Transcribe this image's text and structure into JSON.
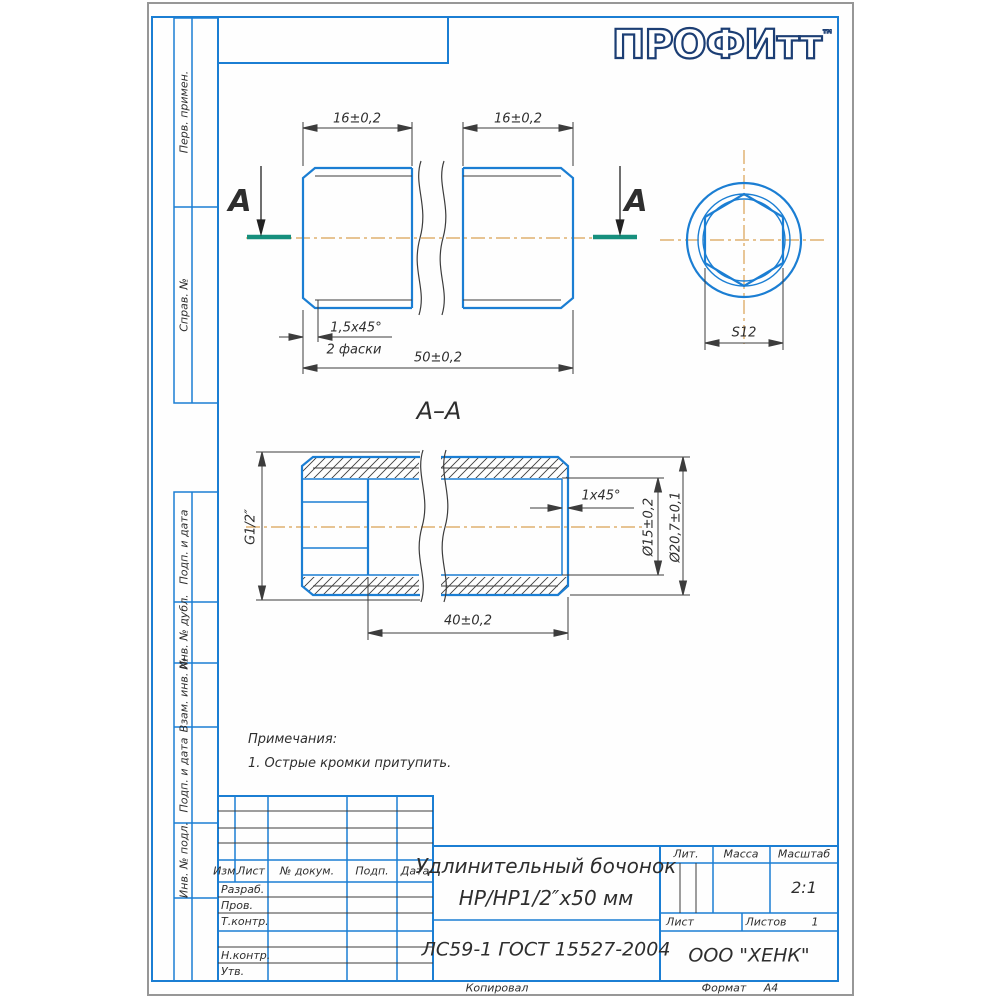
{
  "colors": {
    "frame_blue": "#1b7ed3",
    "line_dark": "#3c3c3c",
    "centerline_orange": "#d9a253",
    "section_teal": "#168f7d",
    "logo_navy": "#1c3e74"
  },
  "logo": {
    "text": "ПРОФИтт",
    "tm": "™"
  },
  "sidebar": {
    "items": [
      {
        "label": "Перв. примен."
      },
      {
        "label": "Справ. №"
      },
      {
        "label": "Подп. и дата"
      },
      {
        "label": "Инв. № дубл."
      },
      {
        "label": "Взам. инв. №"
      },
      {
        "label": "Подп. и дата"
      },
      {
        "label": "Инв. № подл."
      }
    ]
  },
  "drawing": {
    "side_view": {
      "section_letter": "А",
      "dim_thread_left": "16±0,2",
      "dim_thread_right": "16±0,2",
      "dim_overall": "50±0,2",
      "dim_chamfer": "1,5х45°",
      "chamfer_note": "2 фаски"
    },
    "end_view": {
      "dim_hex": "S12"
    },
    "section_view": {
      "label": "А–А",
      "dim_thread": "G1/2″",
      "dim_chamfer": "1х45°",
      "dim_bore": "Ø15±0,2",
      "dim_outer": "Ø20,7±0,1",
      "dim_length": "40±0,2"
    }
  },
  "notes": {
    "heading": "Примечания:",
    "item1": "1. Острые кромки притупить."
  },
  "title_block": {
    "header": {
      "izm": "Изм.",
      "list": "Лист",
      "doc": "№ докум.",
      "sign": "Подп.",
      "date": "Дата"
    },
    "rows": {
      "r1": "Разраб.",
      "r2": "Пров.",
      "r3": "Т.контр.",
      "r4": "Н.контр.",
      "r5": "Утв."
    },
    "name_line1": "Удлинительный бочонок",
    "name_line2": "НР/НР1/2″х50 мм",
    "material": "ЛС59-1 ГОСТ 15527-2004",
    "lit_label": "Лит.",
    "mass_label": "Масса",
    "scale_label": "Масштаб",
    "scale_value": "2:1",
    "sheet_label": "Лист",
    "sheets_label": "Листов",
    "sheets_value": "1",
    "company": "ООО \"ХЕНК\"",
    "copied_label": "Копировал",
    "format_label": "Формат",
    "format_value": "А4"
  }
}
